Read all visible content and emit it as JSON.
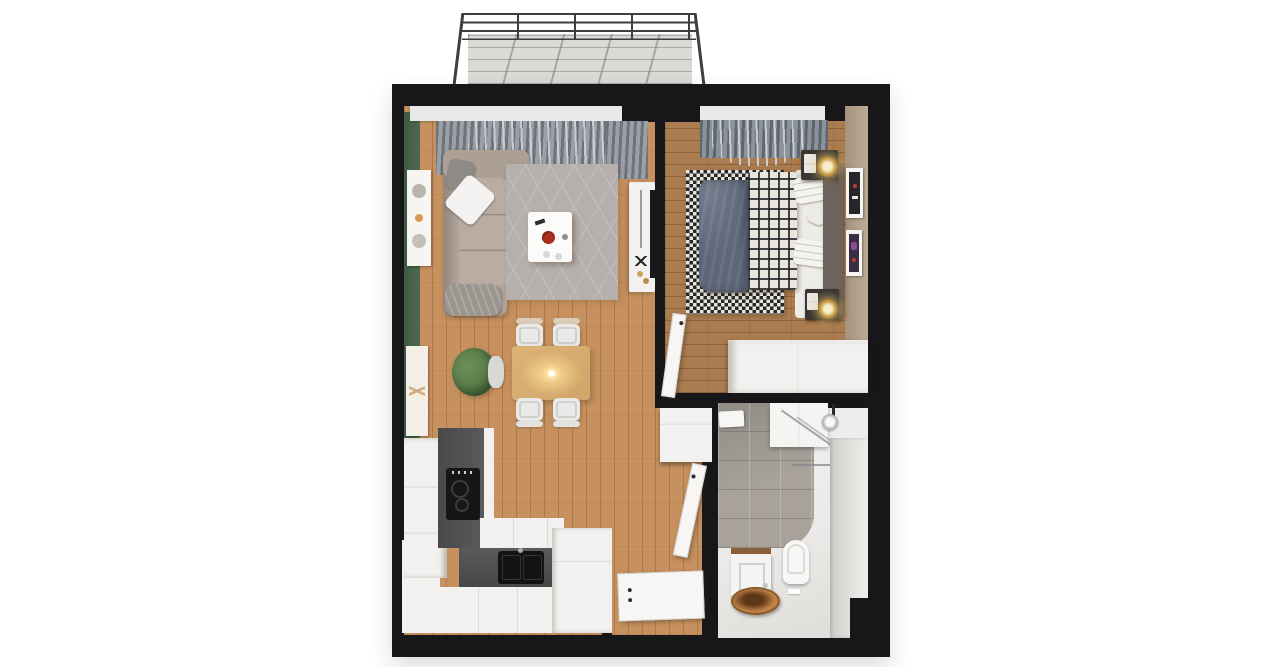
{
  "scene": {
    "type": "3d-floorplan-top-view",
    "description": "Top-down 3D architectural render of a one-bedroom apartment with an open living/dining/kitchen area, bedroom, bathroom, entry hall and balcony, surrounded by thick black cut walls on a white background",
    "background_color": "#ffffff",
    "wall_color": "#17171a"
  },
  "palette": {
    "bg": "#ffffff",
    "wall": "#17171a",
    "rail": "#3e3e42",
    "balcony_floor": "#dcdad6",
    "wood_light": "#c6915e",
    "wood_dark": "#ab7c4f",
    "green_wall": "#4d6a50",
    "tan_wall": "#b2a08c",
    "rug_gray": "#b5b0ac",
    "sofa_beige": "#b3a79d",
    "drape_gray": "#82878f",
    "sheer_white": "#f4f5f7",
    "duvet_blue": "#5d6779",
    "plaid_dark": "#26272c",
    "plaid_light": "#e9e6e0",
    "headboard_brown": "#6b635c",
    "lamp_gold": "#c59a45",
    "tile_gray": "#a8a29b",
    "bath_floor": "#eceae8",
    "counter_graphite": "#525151",
    "appliance_black": "#161618",
    "cabinet_white": "#f2f1ef",
    "copper": "#b5793f",
    "table_wood": "#d2a66a",
    "plant_green": "#567a47",
    "accent_red": "#ab2f1e"
  },
  "rooms": [
    {
      "id": "balcony",
      "items": [
        {
          "name": "metal-railing",
          "color": "#3e3e42"
        },
        {
          "name": "concrete-floor-with-grid-shadows",
          "color": "#dcdad6"
        }
      ]
    },
    {
      "id": "living-dining-kitchen",
      "items": [
        {
          "name": "green-accent-wall",
          "color": "#4d6a50"
        },
        {
          "name": "wall-art-frame",
          "count": 2
        },
        {
          "name": "window-lintel-beam",
          "color": "#e9e9ea"
        },
        {
          "name": "gray-drapes",
          "color": "#82878f"
        },
        {
          "name": "white-sheer-curtain",
          "color": "#f4f5f7"
        },
        {
          "name": "corner-sofa",
          "color": "#b3a79d"
        },
        {
          "name": "white-pillow"
        },
        {
          "name": "gray-throw-blanket"
        },
        {
          "name": "area-rug",
          "color": "#b5b0ac"
        },
        {
          "name": "coffee-table",
          "color": "#fbfbfa",
          "decor": [
            "red-bowl",
            "remote",
            "cups"
          ]
        },
        {
          "name": "tv-console",
          "color": "#f2f1ef"
        },
        {
          "name": "wall-mounted-tv",
          "color": "#19191b"
        },
        {
          "name": "dining-table",
          "color": "#d2a66a"
        },
        {
          "name": "dining-chair",
          "count": 4,
          "color": "#e9e9e7"
        },
        {
          "name": "pendant-light-glow"
        },
        {
          "name": "potted-plant",
          "color": "#567a47"
        },
        {
          "name": "tall-kitchen-cabinet",
          "color": "#f2f1ef"
        },
        {
          "name": "graphite-countertop",
          "color": "#525151"
        },
        {
          "name": "induction-cooktop",
          "color": "#161618"
        },
        {
          "name": "black-double-sink",
          "color": "#131315"
        },
        {
          "name": "white-cabinet-fronts",
          "color": "#f2f1ef"
        }
      ]
    },
    {
      "id": "bedroom",
      "items": [
        {
          "name": "double-bed"
        },
        {
          "name": "blue-duvet",
          "color": "#5d6779"
        },
        {
          "name": "plaid-blanket",
          "colors": [
            "#26272c",
            "#e9e6e0"
          ]
        },
        {
          "name": "white-pillows",
          "count": 3
        },
        {
          "name": "headboard",
          "color": "#6b635c"
        },
        {
          "name": "checkered-rug",
          "colors": [
            "#26272c",
            "#e7e4da"
          ]
        },
        {
          "name": "nightstand",
          "count": 2,
          "color": "#3a3631"
        },
        {
          "name": "gold-table-lamp",
          "count": 2,
          "color": "#c59a45"
        },
        {
          "name": "wall-art-frame",
          "count": 2
        },
        {
          "name": "wardrobe",
          "color": "#f2f1ef"
        },
        {
          "name": "tan-walls",
          "color": "#b2a08c"
        },
        {
          "name": "gray-blue-drapes"
        },
        {
          "name": "white-sheer-curtain"
        },
        {
          "name": "open-door-leaf"
        }
      ]
    },
    {
      "id": "bathroom",
      "items": [
        {
          "name": "gray-wall-tiles",
          "color": "#a8a29b"
        },
        {
          "name": "white-floor",
          "color": "#eceae8"
        },
        {
          "name": "mirror-cabinet"
        },
        {
          "name": "walk-in-shower-glass"
        },
        {
          "name": "shower-head"
        },
        {
          "name": "wall-hung-toilet"
        },
        {
          "name": "washing-machine"
        },
        {
          "name": "copper-vessel-sink",
          "color": "#b5793f"
        },
        {
          "name": "towel"
        },
        {
          "name": "side-bench-ledge"
        },
        {
          "name": "open-door-leaf"
        }
      ]
    },
    {
      "id": "entry-hall",
      "items": [
        {
          "name": "wood-floor",
          "color": "#c6915e"
        },
        {
          "name": "hall-cabinet",
          "color": "#f2f1ef"
        },
        {
          "name": "open-front-door-leaf"
        }
      ]
    }
  ]
}
